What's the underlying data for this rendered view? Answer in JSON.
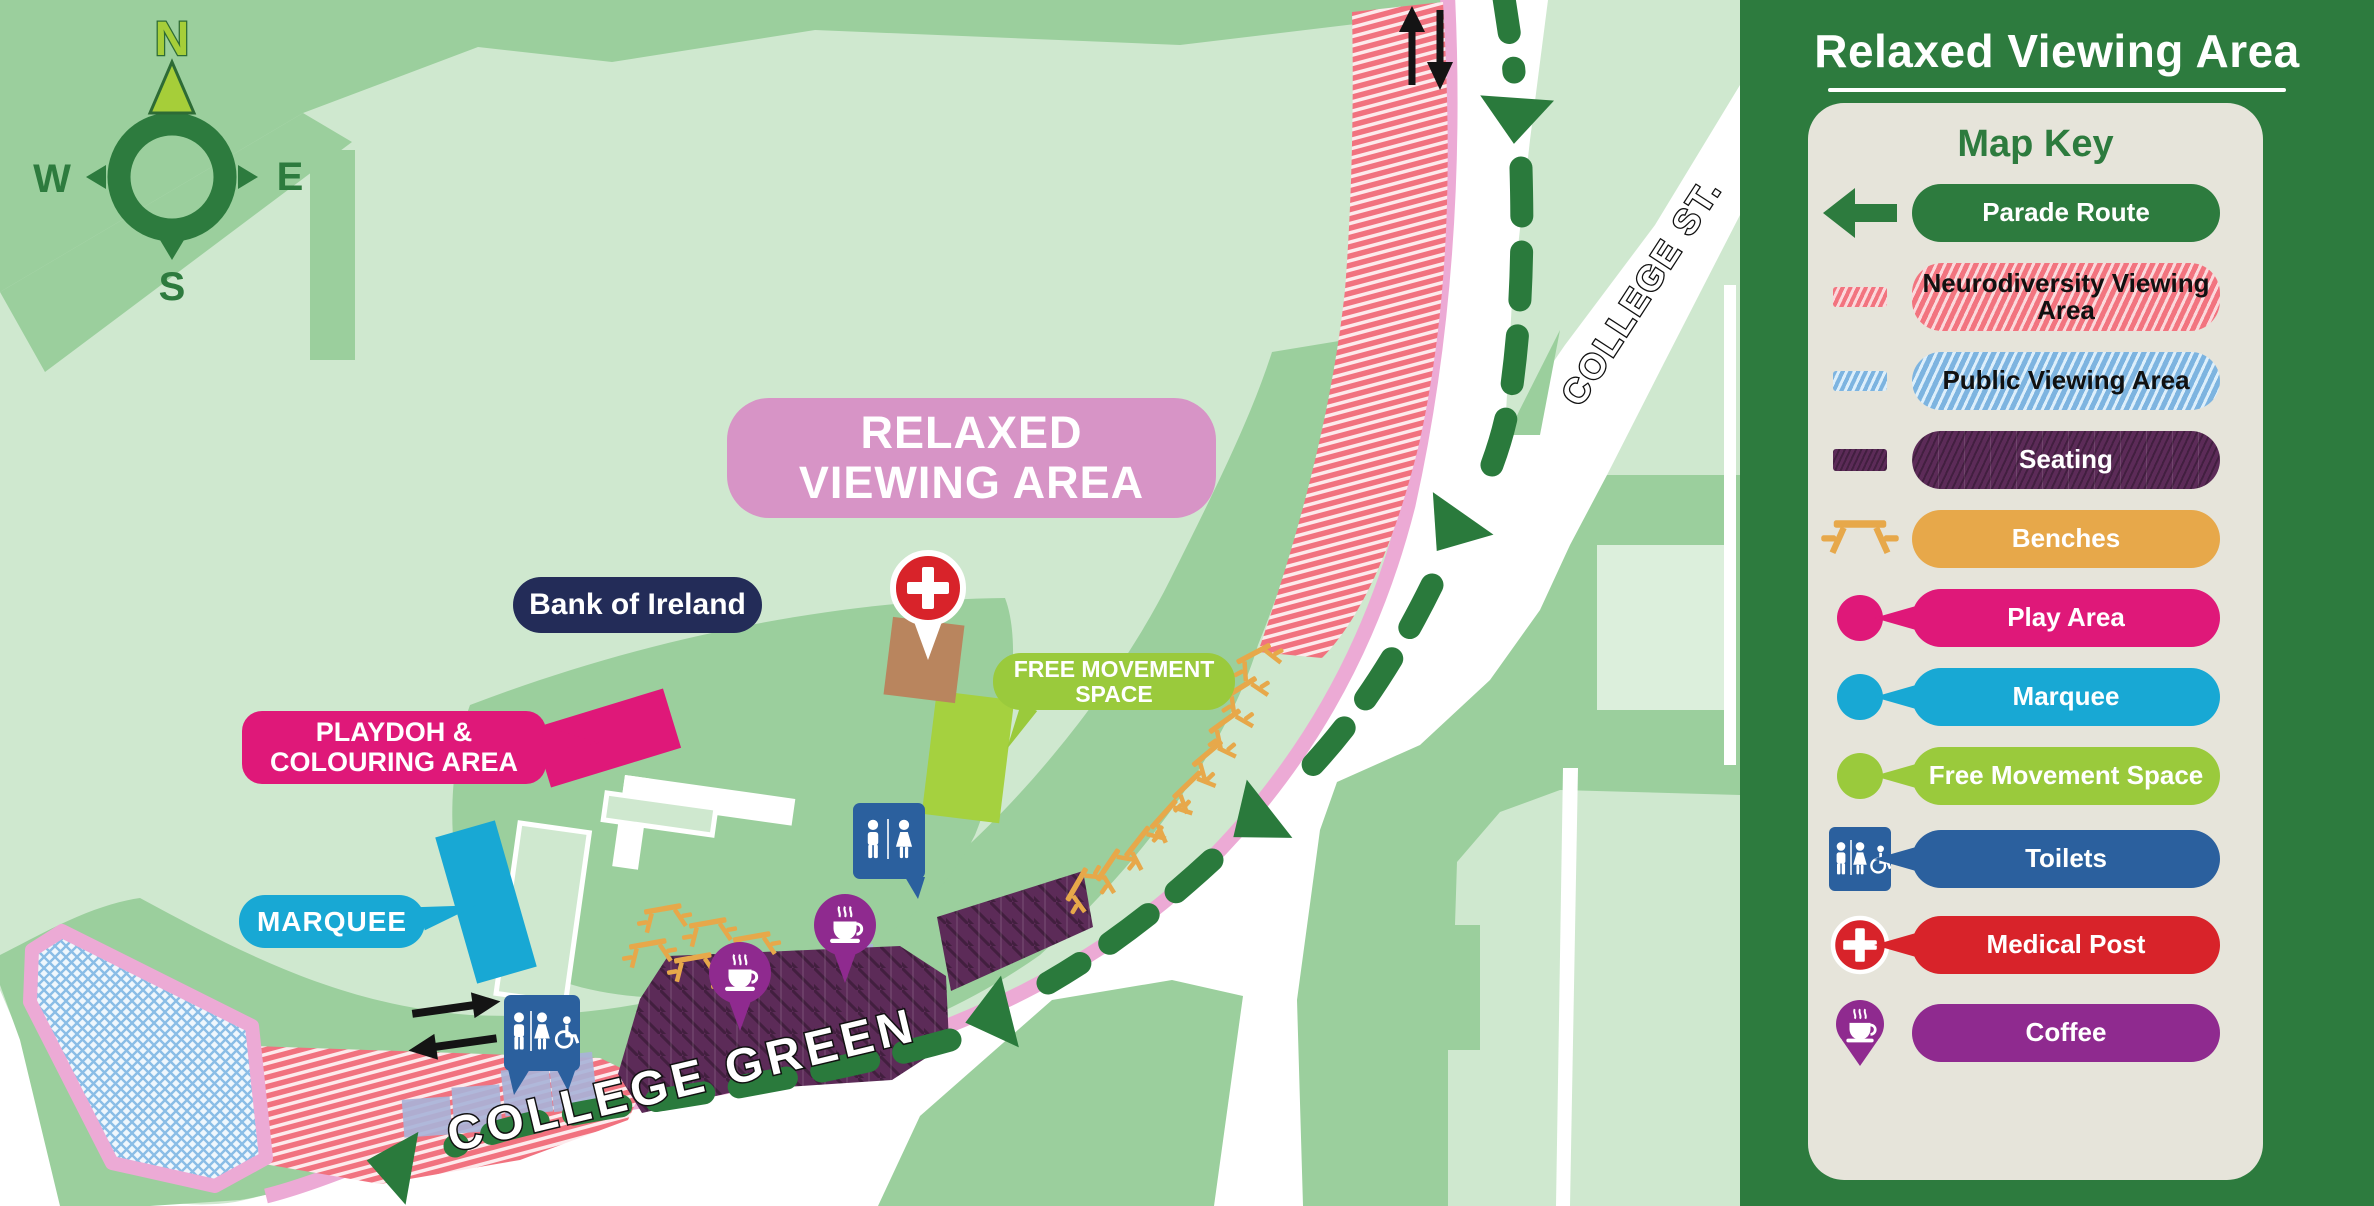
{
  "panel": {
    "title": "Relaxed Viewing Area",
    "key_title": "Map Key",
    "items": [
      {
        "label": "Parade Route",
        "icon": "parade-arrow-icon",
        "color": "#2d7b3e"
      },
      {
        "label": "Neurodiversity Viewing Area",
        "icon": "pink-hatch-swatch",
        "color": "#f2747f"
      },
      {
        "label": "Public Viewing Area",
        "icon": "blue-hatch-swatch",
        "color": "#7db4e0"
      },
      {
        "label": "Seating",
        "icon": "purple-swatch",
        "color": "#5c2b58"
      },
      {
        "label": "Benches",
        "icon": "picnic-table-icon",
        "color": "#e7a84a"
      },
      {
        "label": "Play Area",
        "icon": "pink-dot-icon",
        "color": "#df1879"
      },
      {
        "label": "Marquee",
        "icon": "cyan-dot-icon",
        "color": "#18a8d4"
      },
      {
        "label": "Free Movement Space",
        "icon": "green-dot-icon",
        "color": "#9aca3c"
      },
      {
        "label": "Toilets",
        "icon": "toilets-sign-icon",
        "color": "#2b609e"
      },
      {
        "label": "Medical Post",
        "icon": "medical-cross-icon",
        "color": "#d8232a"
      },
      {
        "label": "Coffee",
        "icon": "coffee-pin-icon",
        "color": "#8f2a8f"
      }
    ]
  },
  "map": {
    "area_label": "RELAXED VIEWING AREA",
    "building_label": "Bank of Ireland",
    "playdoh_label": "PLAYDOH & COLOURING AREA",
    "marquee_label": "MARQUEE",
    "free_movement_label": "FREE MOVEMENT SPACE",
    "street_college_green": "COLLEGE GREEN",
    "street_college_st": "COLLEGE ST.",
    "compass": {
      "north": "N",
      "east": "E",
      "south": "S",
      "west": "W"
    },
    "colors": {
      "panel_green": "#2d7b3e",
      "map_light_green": "#cfe8cf",
      "map_mid_green": "#9bcf9d",
      "route_green": "#2a7a3c",
      "curb_pink": "#ecaad5",
      "neuro_pink": "#f2747f",
      "public_blue": "#7db4e0",
      "seating_purple": "#5c2b58",
      "bench_orange": "#e7a84a",
      "play_pink": "#df1879",
      "marquee_cyan": "#18a8d4",
      "free_move_green": "#9aca3c",
      "toilets_blue": "#2b609e",
      "medical_red": "#d8232a",
      "coffee_purple": "#8f2a8f",
      "area_label_pink": "#d794c6",
      "building_navy": "#232c58"
    }
  }
}
